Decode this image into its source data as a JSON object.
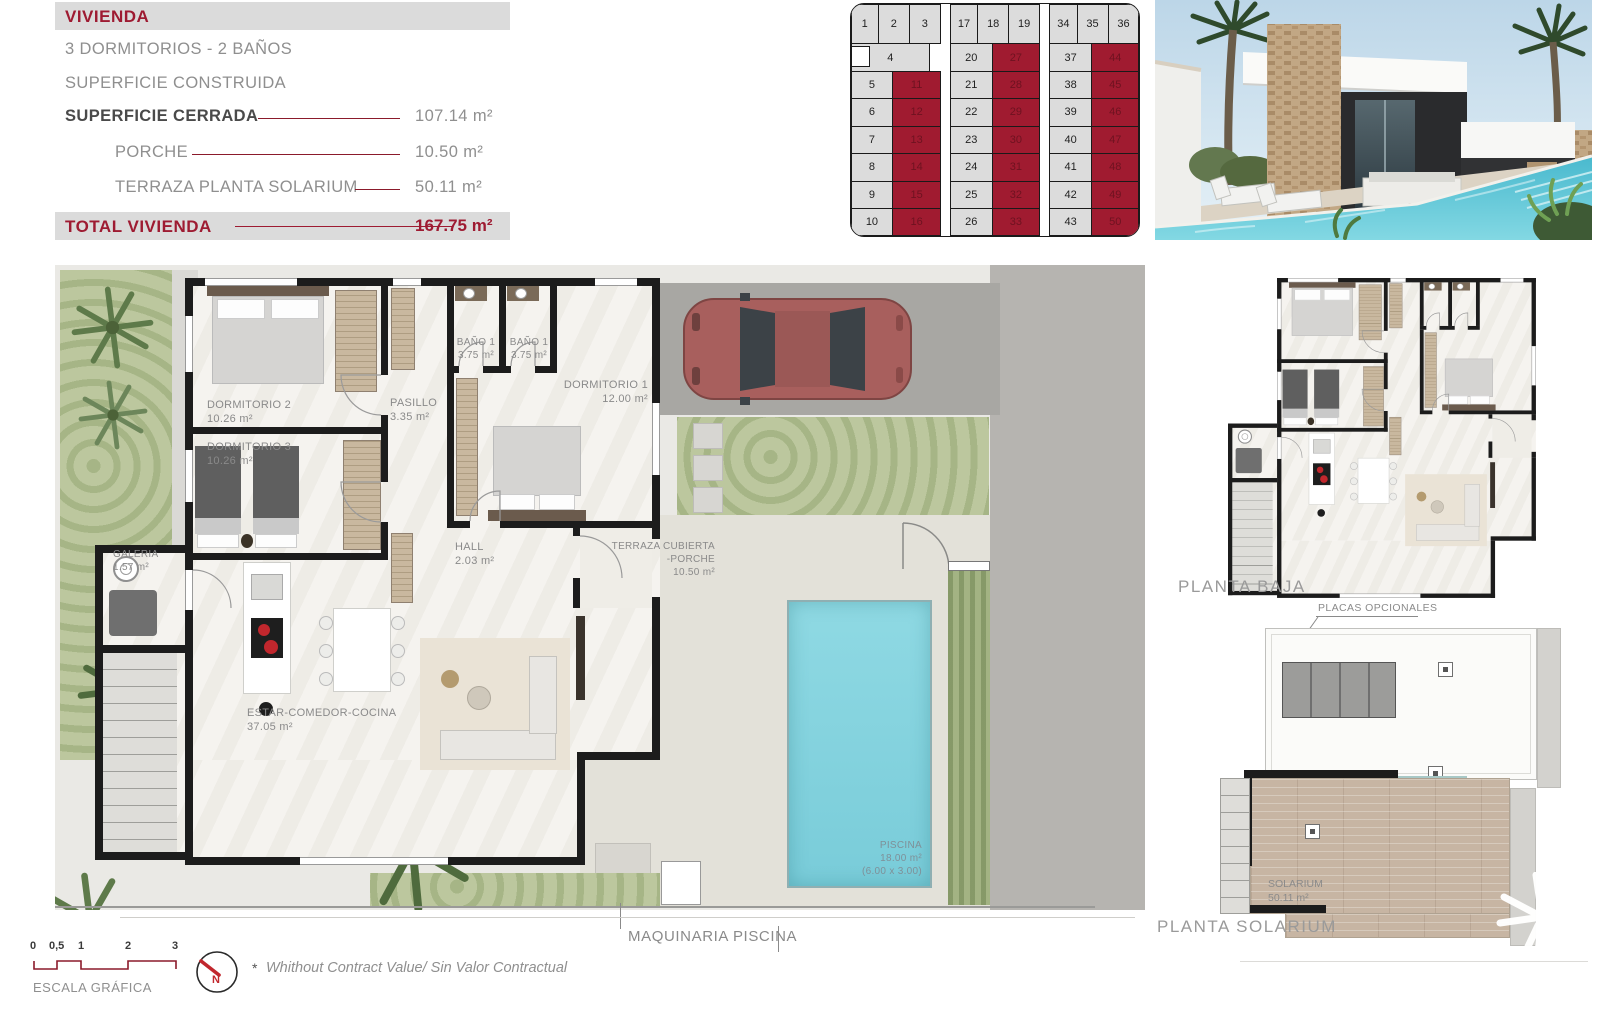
{
  "info_panel": {
    "title": "VIVIENDA",
    "subtitle1": "3 DORMITORIOS - 2 BAÑOS",
    "subtitle2": "SUPERFICIE CONSTRUIDA",
    "rows": [
      {
        "label": "SUPERFICIE CERRADA",
        "value": "107.14 m²"
      },
      {
        "label": "PORCHE",
        "value": "10.50 m²"
      },
      {
        "label": "TERRAZA PLANTA SOLARIUM",
        "value": "50.11 m²"
      }
    ],
    "total_label": "TOTAL VIVIENDA",
    "total_value": "167.75 m²"
  },
  "site_grid": {
    "highlight_color": "#A01B30",
    "groups": [
      {
        "top_row": [
          "1",
          "2",
          "3"
        ],
        "wide_cell": "4",
        "rows": [
          [
            "5",
            "11"
          ],
          [
            "6",
            "12"
          ],
          [
            "7",
            "13"
          ],
          [
            "8",
            "14"
          ],
          [
            "9",
            "15"
          ],
          [
            "10",
            "16"
          ]
        ]
      },
      {
        "top_row": [
          "17",
          "18",
          "19"
        ],
        "rows": [
          [
            "20",
            "27"
          ],
          [
            "21",
            "28"
          ],
          [
            "22",
            "29"
          ],
          [
            "23",
            "30"
          ],
          [
            "24",
            "31"
          ],
          [
            "25",
            "32"
          ],
          [
            "26",
            "33"
          ]
        ]
      },
      {
        "top_row": [
          "34",
          "35",
          "36"
        ],
        "rows": [
          [
            "37",
            "44"
          ],
          [
            "38",
            "45"
          ],
          [
            "39",
            "46"
          ],
          [
            "40",
            "47"
          ],
          [
            "41",
            "48"
          ],
          [
            "42",
            "49"
          ],
          [
            "43",
            "50"
          ]
        ]
      }
    ]
  },
  "floor_plan": {
    "rooms": {
      "dormitorio2": {
        "name": "DORMITORIO 2",
        "area": "10.26 m²"
      },
      "dormitorio3": {
        "name": "DORMITORIO 3",
        "area": "10.26 m²"
      },
      "pasillo": {
        "name": "PASILLO",
        "area": "3.35 m²"
      },
      "bano1a": {
        "name": "BAÑO 1",
        "area": "3.75 m²"
      },
      "bano1b": {
        "name": "BAÑO 1",
        "area": "3.75 m²"
      },
      "dormitorio1": {
        "name": "DORMITORIO 1",
        "area": "12.00 m²"
      },
      "hall": {
        "name": "HALL",
        "area": "2.03 m²"
      },
      "terraza": {
        "name": "TERRAZA CUBIERTA",
        "name2": "-PORCHE",
        "area": "10.50 m²"
      },
      "estar": {
        "name": "ESTAR-COMEDOR-COCINA",
        "area": "37.05 m²"
      },
      "galeria": {
        "name": "GALERIA",
        "area": "1.57 m²"
      },
      "piscina": {
        "name": "PISCINA",
        "area": "18.00 m²",
        "dims": "(6.00 x 3.00)"
      }
    },
    "maquinaria_label": "MAQUINARIA PISCINA"
  },
  "mini_plans": {
    "planta_baja_label": "PLANTA BAJA",
    "solarium_label": "PLANTA SOLARIUM",
    "placas_label": "PLACAS OPCIONALES",
    "solarium_room": {
      "name": "SOLARIUM",
      "area": "50.11 m²"
    }
  },
  "footer": {
    "scale_numbers": [
      "0",
      "0,5",
      "1",
      "2",
      "3"
    ],
    "scale_label": "ESCALA GRÁFICA",
    "compass_label": "N",
    "disclaimer_mark": "*",
    "disclaimer": "Whithout Contract Value/ Sin Valor Contractual"
  },
  "colors": {
    "accent_crimson": "#9E1B32",
    "grid_red": "#A01B30",
    "bar_gray": "#DBDBDB",
    "pool_water": "#7FD0DC",
    "plan_wall": "#1C1C1C"
  }
}
